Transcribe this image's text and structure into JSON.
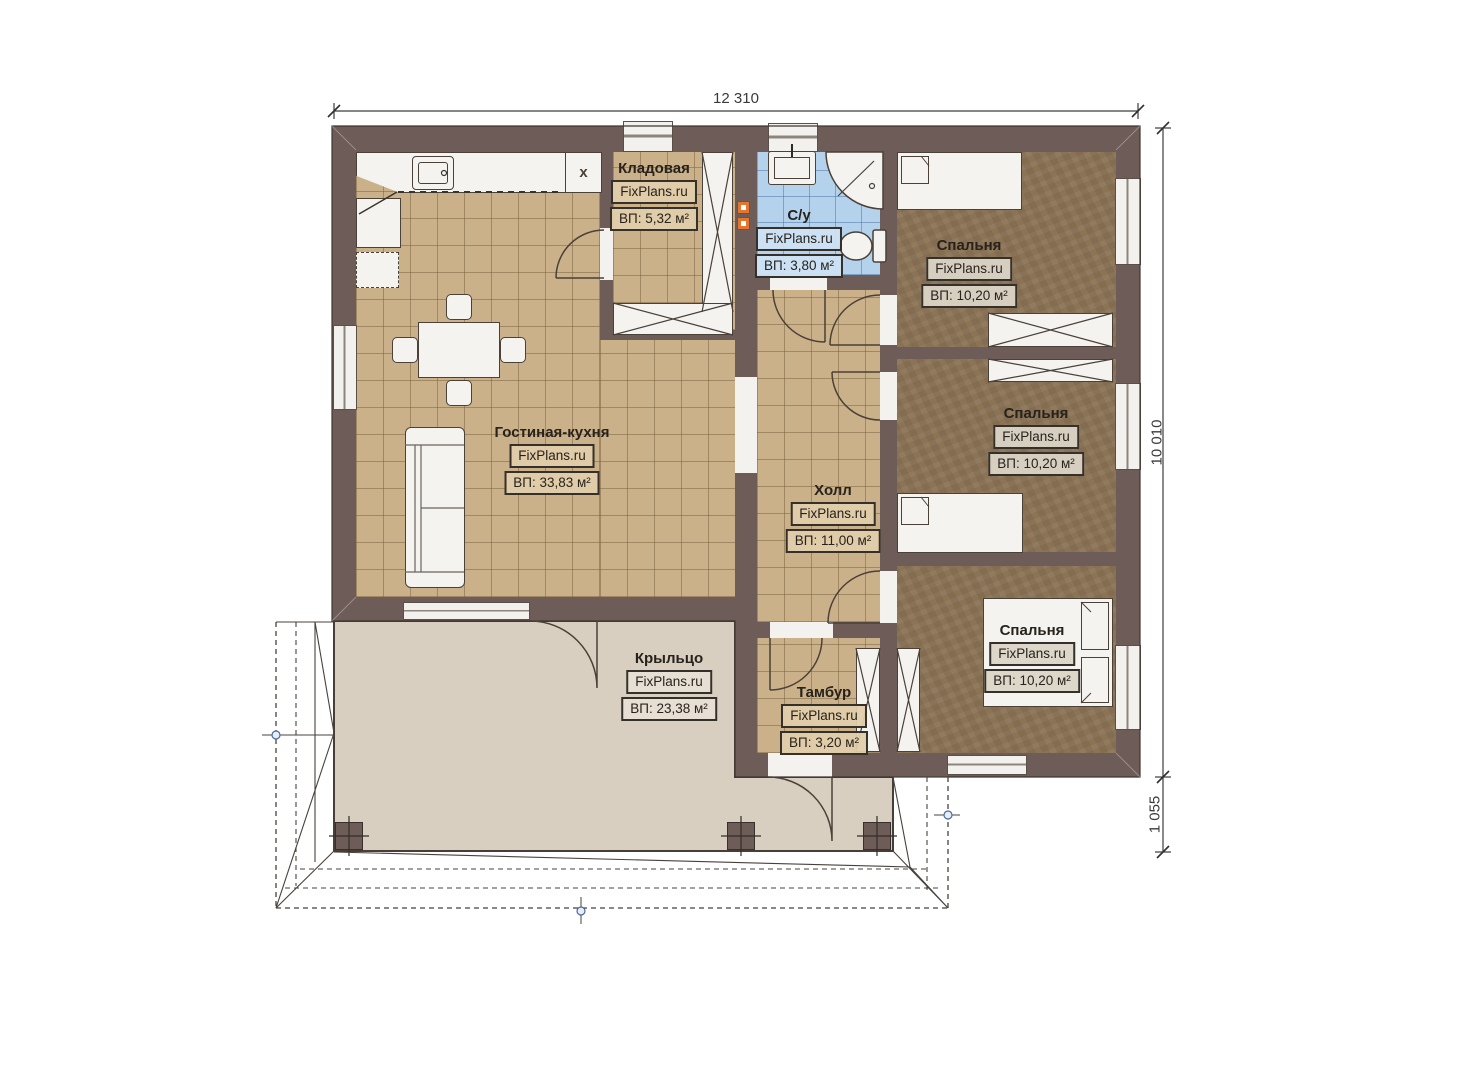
{
  "brand": "FixPlans.ru",
  "dimensions": {
    "top": "12 310",
    "right": "10 010",
    "right_bottom": "1 055"
  },
  "rooms": [
    {
      "id": "living_kitchen",
      "name": "Гостиная-кухня",
      "area": "ВП: 33,83 м²"
    },
    {
      "id": "storage",
      "name": "Кладовая",
      "area": "ВП: 5,32 м²"
    },
    {
      "id": "bathroom",
      "name": "С/у",
      "area": "ВП: 3,80 м²"
    },
    {
      "id": "hall",
      "name": "Холл",
      "area": "ВП: 11,00 м²"
    },
    {
      "id": "vestibule",
      "name": "Тамбур",
      "area": "ВП: 3,20 м²"
    },
    {
      "id": "bedroom_top",
      "name": "Спальня",
      "area": "ВП: 10,20 м²"
    },
    {
      "id": "bedroom_middle",
      "name": "Спальня",
      "area": "ВП: 10,20 м²"
    },
    {
      "id": "bedroom_bottom",
      "name": "Спальня",
      "area": "ВП: 10,20 м²"
    },
    {
      "id": "porch",
      "name": "Крыльцо",
      "area": "ВП: 23,38 м²"
    }
  ],
  "icons": {
    "stove_x_cabinet": "x"
  },
  "colors": {
    "wall": "#6e5c59",
    "tile_floor": "#cbb189",
    "bedroom_floor": "#8b7355",
    "bathroom_floor": "#b4d2ec",
    "porch_floor": "#d9cfc0",
    "accent_marker": "#e4762f",
    "roof_node": "#49679c"
  }
}
